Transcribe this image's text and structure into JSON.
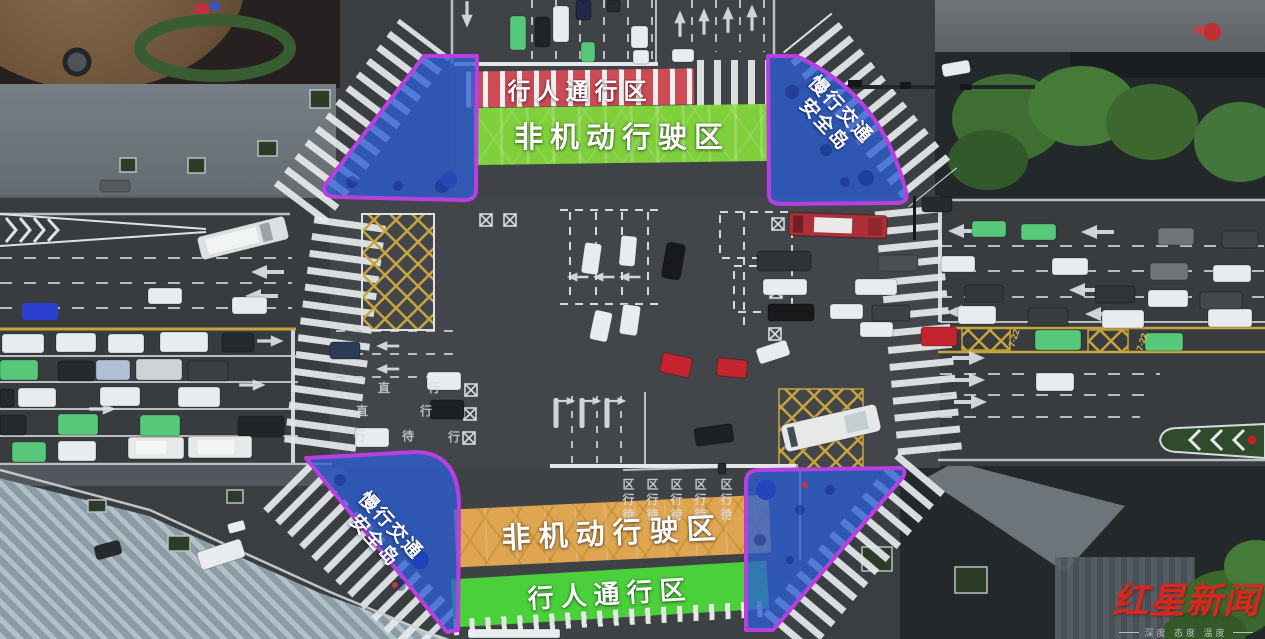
{
  "labels": {
    "north_pedestrian": "行人通行区",
    "north_nonmotor": "非机动行驶区",
    "south_nonmotor": "非机动行驶区",
    "south_pedestrian": "行人通行区",
    "island_line1": "慢行交通",
    "island_line2": "安全岛"
  },
  "road_text": {
    "bus_lane": "7-22",
    "waiting_columns": [
      "区行待",
      "区行待",
      "区行待",
      "区行待",
      "区行待"
    ],
    "lane_chars": [
      "直",
      "行",
      "直",
      "行",
      "行",
      "待",
      "行"
    ]
  },
  "watermark": {
    "brand": "红星新闻",
    "tagline": "深度 态度 温度"
  },
  "colors": {
    "pedestrian_band_red": "#e14c58",
    "nonmotor_band_green": "#83d73b",
    "nonmotor_band_orange": "#e9ab53",
    "pedestrian_band_green": "#4bd83a",
    "island_fill_blue": "#2d5fd2",
    "island_border_purple": "#b83fe0",
    "taxi_green": "#57c87a",
    "bus_lane_yellow": "#c9a43e",
    "watermark_red": "#d6281e"
  }
}
